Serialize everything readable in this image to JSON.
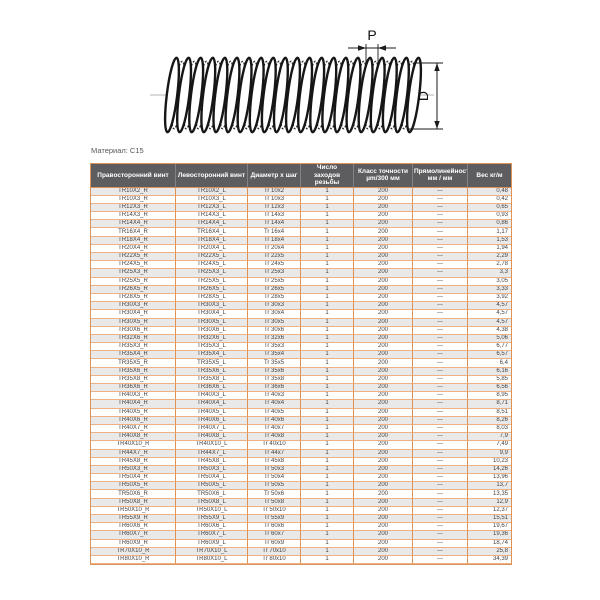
{
  "drawing": {
    "pitch_label": "P",
    "diameter_label": "D"
  },
  "material_note": "Материал: C15",
  "colors": {
    "border_orange": "#dd9257",
    "border_light": "#ecb285",
    "header_bg": "#5d5d5f",
    "row_alt": "#e9e9e9"
  },
  "table": {
    "headers": [
      "Правосторонний винт",
      "Левосторонний винт",
      "Диаметр х шаг",
      "Число\nзаходов резьбы",
      "Класс точности\nµm/300 мм",
      "Прямолинейность\nмм / мм",
      "Вес кг/м"
    ],
    "rows": [
      [
        "TR10X2_R",
        "TR10X2_L",
        "Tr 10x2",
        "1",
        "200",
        "---",
        "0,48"
      ],
      [
        "TR10X3_R",
        "TR10X3_L",
        "Tr 10x3",
        "1",
        "200",
        "---",
        "0,42"
      ],
      [
        "TR12X3_R",
        "TR12X3_L",
        "Tr 12x3",
        "1",
        "200",
        "---",
        "0,65"
      ],
      [
        "TR14X3_R",
        "TR14X3_L",
        "Tr 14x3",
        "1",
        "200",
        "---",
        "0,93"
      ],
      [
        "TR14X4_R",
        "TR14X4_L",
        "Tr 14x4",
        "1",
        "200",
        "---",
        "0,86"
      ],
      [
        "TR16X4_R",
        "TR16X4_L",
        "Tr 16x4",
        "1",
        "200",
        "---",
        "1,17"
      ],
      [
        "TR18X4_R",
        "TR18X4_L",
        "Tr 18x4",
        "1",
        "200",
        "---",
        "1,53"
      ],
      [
        "TR20X4_R",
        "TR20X4_L",
        "Tr 20x4",
        "1",
        "200",
        "---",
        "1,94"
      ],
      [
        "TR22X5_R",
        "TR22X5_L",
        "Tr 22x5",
        "1",
        "200",
        "---",
        "2,29"
      ],
      [
        "TR24X5_R",
        "TR24X5_L",
        "Tr 24x5",
        "1",
        "200",
        "---",
        "2,78"
      ],
      [
        "TR25X3_R",
        "TR25X3_L",
        "Tr 25x3",
        "1",
        "200",
        "---",
        "3,3"
      ],
      [
        "TR25X5_R",
        "TR25X5_L",
        "Tr 25x5",
        "1",
        "200",
        "---",
        "3,05"
      ],
      [
        "TR26X5_R",
        "TR26X5_L",
        "Tr 26x5",
        "1",
        "200",
        "---",
        "3,33"
      ],
      [
        "TR28X5_R",
        "TR28X5_L",
        "Tr 28x5",
        "1",
        "200",
        "---",
        "3,92"
      ],
      [
        "TR30X3_R",
        "TR30X3_L",
        "Tr 30x3",
        "1",
        "200",
        "---",
        "4,57"
      ],
      [
        "TR30X4_R",
        "TR30X4_L",
        "Tr 30x4",
        "1",
        "200",
        "---",
        "4,57"
      ],
      [
        "TR30X5_R",
        "TR30X5_L",
        "Tr 30x5",
        "1",
        "200",
        "---",
        "4,57"
      ],
      [
        "TR30X6_R",
        "TR30X6_L",
        "Tr 30x6",
        "1",
        "200",
        "---",
        "4,38"
      ],
      [
        "TR32X6_R",
        "TR32X6_L",
        "Tr 32x6",
        "1",
        "200",
        "---",
        "5,06"
      ],
      [
        "TR35X3_R",
        "TR35X3_L",
        "Tr 35x3",
        "1",
        "200",
        "---",
        "6,77"
      ],
      [
        "TR35X4_R",
        "TR35X4_L",
        "Tr 35x4",
        "1",
        "200",
        "---",
        "6,57"
      ],
      [
        "TR35X5_R",
        "TR35X5_L",
        "Tr 35x5",
        "1",
        "200",
        "---",
        "6,4"
      ],
      [
        "TR35X6_R",
        "TR35X6_L",
        "Tr 35x6",
        "1",
        "200",
        "---",
        "6,16"
      ],
      [
        "TR35X8_R",
        "TR35X8_L",
        "Tr 35x8",
        "1",
        "200",
        "---",
        "5,85"
      ],
      [
        "TR36X6_R",
        "TR36X6_L",
        "Tr 36x6",
        "1",
        "200",
        "---",
        "6,56"
      ],
      [
        "TR40X3_R",
        "TR40X3_L",
        "Tr 40x3",
        "1",
        "200",
        "---",
        "8,95"
      ],
      [
        "TR40X4_R",
        "TR40X4_L",
        "Tr 40x4",
        "1",
        "200",
        "---",
        "8,71"
      ],
      [
        "TR40X5_R",
        "TR40X5_L",
        "Tr 40x5",
        "1",
        "200",
        "---",
        "8,51"
      ],
      [
        "TR40X6_R",
        "TR40X6_L",
        "Tr 40x6",
        "1",
        "200",
        "---",
        "8,26"
      ],
      [
        "TR40X7_R",
        "TR40X7_L",
        "Tr 40x7",
        "1",
        "200",
        "---",
        "8,03"
      ],
      [
        "TR40X8_R",
        "TR40X8_L",
        "Tr 40x8",
        "1",
        "200",
        "---",
        "7,9"
      ],
      [
        "TR40X10_R",
        "TR40X10_L",
        "Tr 40x10",
        "1",
        "200",
        "---",
        "7,49"
      ],
      [
        "TR44X7_R",
        "TR44X7_L",
        "Tr 44x7",
        "1",
        "200",
        "---",
        "9,9"
      ],
      [
        "TR45X8_R",
        "TR45X8_L",
        "Tr 45x8",
        "1",
        "200",
        "---",
        "10,23"
      ],
      [
        "TR50X3_R",
        "TR50X3_L",
        "Tr 50x3",
        "1",
        "200",
        "---",
        "14,26"
      ],
      [
        "TR50X4_R",
        "TR50X4_L",
        "Tr 50x4",
        "1",
        "200",
        "---",
        "13,96"
      ],
      [
        "TR50X5_R",
        "TR50X5_L",
        "Tr 50x5",
        "1",
        "200",
        "---",
        "13,7"
      ],
      [
        "TR50X6_R",
        "TR50X6_L",
        "Tr 50x6",
        "1",
        "200",
        "---",
        "13,35"
      ],
      [
        "TR50X8_R",
        "TR50X8_L",
        "Tr 50x8",
        "1",
        "200",
        "---",
        "12,9"
      ],
      [
        "TR50X10_R",
        "TR50X10_L",
        "Tr 50x10",
        "1",
        "200",
        "---",
        "12,37"
      ],
      [
        "TR55X9_R",
        "TR55X9_L",
        "Tr 55x9",
        "1",
        "200",
        "---",
        "15,51"
      ],
      [
        "TR60X6_R",
        "TR60X6_L",
        "Tr 60x6",
        "1",
        "200",
        "---",
        "19,67"
      ],
      [
        "TR60X7_R",
        "TR60X7_L",
        "Tr 60x7",
        "1",
        "200",
        "---",
        "19,36"
      ],
      [
        "TR60X9_R",
        "TR60X9_L",
        "Tr 60x9",
        "1",
        "200",
        "---",
        "18,74"
      ],
      [
        "TR70X10_R",
        "TR70X10_L",
        "Tr 70x10",
        "1",
        "200",
        "---",
        "25,8"
      ],
      [
        "TR80X10_R",
        "TR80X10_L",
        "Tr 80x10",
        "1",
        "200",
        "---",
        "34,39"
      ]
    ]
  }
}
